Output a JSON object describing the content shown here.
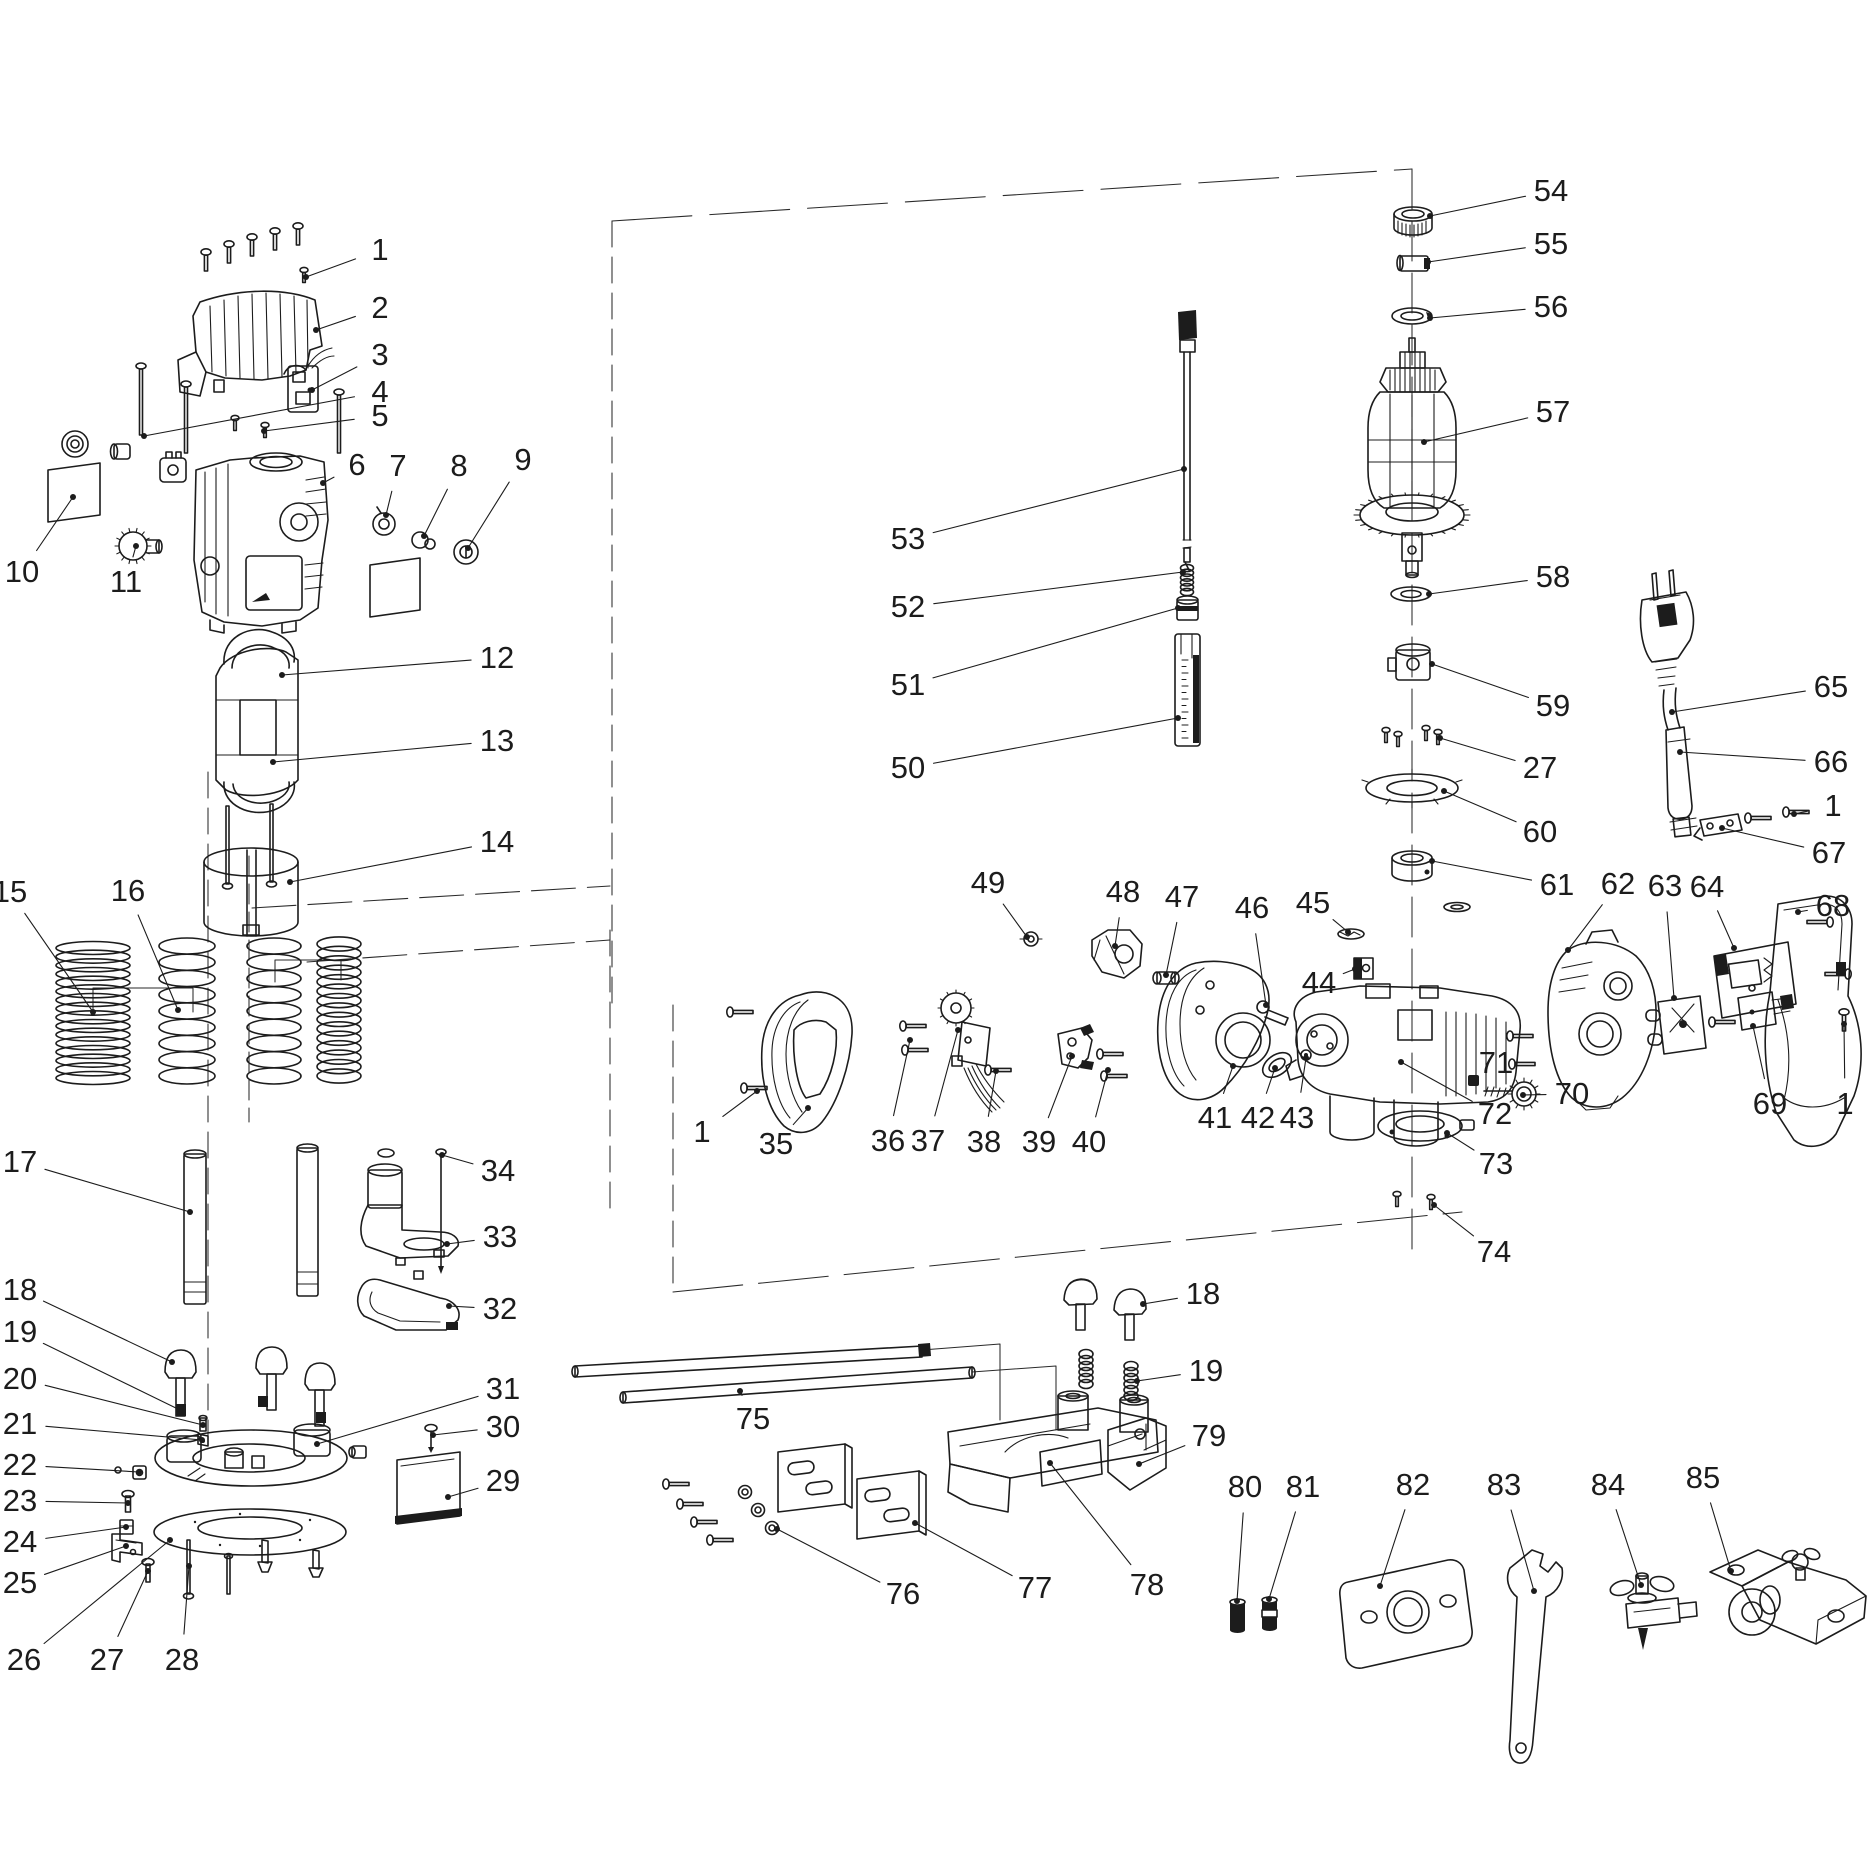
{
  "diagram": {
    "background": "#ffffff",
    "line_color": "#1c1c1c",
    "label_font_px": 31,
    "labels": [
      {
        "t": "1",
        "x": 380,
        "y": 250,
        "lx": 306,
        "ly": 277
      },
      {
        "t": "2",
        "x": 380,
        "y": 308,
        "lx": 316,
        "ly": 330
      },
      {
        "t": "3",
        "x": 380,
        "y": 355,
        "lx": 312,
        "ly": 390
      },
      {
        "t": "4",
        "x": 380,
        "y": 392,
        "lx": 144,
        "ly": 436
      },
      {
        "t": "5",
        "x": 380,
        "y": 416,
        "lx": 264,
        "ly": 431
      },
      {
        "t": "6",
        "x": 357,
        "y": 465,
        "lx": 323,
        "ly": 483
      },
      {
        "t": "7",
        "x": 398,
        "y": 466,
        "lx": 386,
        "ly": 515
      },
      {
        "t": "8",
        "x": 459,
        "y": 466,
        "lx": 424,
        "ly": 536
      },
      {
        "t": "9",
        "x": 523,
        "y": 460,
        "lx": 468,
        "ly": 548
      },
      {
        "t": "10",
        "x": 22,
        "y": 572,
        "lx": 73,
        "ly": 497
      },
      {
        "t": "11",
        "x": 126,
        "y": 582,
        "lx": 136,
        "ly": 546
      },
      {
        "t": "12",
        "x": 497,
        "y": 658,
        "lx": 282,
        "ly": 675
      },
      {
        "t": "13",
        "x": 497,
        "y": 741,
        "lx": 273,
        "ly": 762
      },
      {
        "t": "14",
        "x": 497,
        "y": 842,
        "lx": 290,
        "ly": 882
      },
      {
        "t": "15",
        "x": 10,
        "y": 892,
        "lx": 93,
        "ly": 1012
      },
      {
        "t": "16",
        "x": 128,
        "y": 891,
        "lx": 178,
        "ly": 1010
      },
      {
        "t": "17",
        "x": 20,
        "y": 1162,
        "lx": 190,
        "ly": 1212
      },
      {
        "t": "18",
        "x": 20,
        "y": 1290,
        "lx": 172,
        "ly": 1362
      },
      {
        "t": "19",
        "x": 20,
        "y": 1332,
        "lx": 180,
        "ly": 1410
      },
      {
        "t": "20",
        "x": 20,
        "y": 1379,
        "lx": 203,
        "ly": 1425
      },
      {
        "t": "21",
        "x": 20,
        "y": 1424,
        "lx": 202,
        "ly": 1440
      },
      {
        "t": "22",
        "x": 20,
        "y": 1465,
        "lx": 139,
        "ly": 1472
      },
      {
        "t": "23",
        "x": 20,
        "y": 1501,
        "lx": 128,
        "ly": 1503
      },
      {
        "t": "24",
        "x": 20,
        "y": 1542,
        "lx": 126,
        "ly": 1527
      },
      {
        "t": "25",
        "x": 20,
        "y": 1583,
        "lx": 126,
        "ly": 1546
      },
      {
        "t": "26",
        "x": 24,
        "y": 1660,
        "lx": 170,
        "ly": 1540
      },
      {
        "t": "27",
        "x": 107,
        "y": 1660,
        "lx": 148,
        "ly": 1571
      },
      {
        "t": "28",
        "x": 182,
        "y": 1660,
        "lx": 189,
        "ly": 1566
      },
      {
        "t": "29",
        "x": 503,
        "y": 1481,
        "lx": 448,
        "ly": 1497
      },
      {
        "t": "30",
        "x": 503,
        "y": 1427,
        "lx": 433,
        "ly": 1435
      },
      {
        "t": "31",
        "x": 503,
        "y": 1389,
        "lx": 317,
        "ly": 1444
      },
      {
        "t": "32",
        "x": 500,
        "y": 1309,
        "lx": 449,
        "ly": 1306
      },
      {
        "t": "33",
        "x": 500,
        "y": 1237,
        "lx": 447,
        "ly": 1244
      },
      {
        "t": "34",
        "x": 498,
        "y": 1171,
        "lx": 442,
        "ly": 1155
      },
      {
        "t": "1",
        "x": 702,
        "y": 1132,
        "lx": 757,
        "ly": 1091
      },
      {
        "t": "35",
        "x": 776,
        "y": 1144,
        "lx": 808,
        "ly": 1108
      },
      {
        "t": "36",
        "x": 888,
        "y": 1141,
        "lx": 910,
        "ly": 1040
      },
      {
        "t": "37",
        "x": 928,
        "y": 1141,
        "lx": 958,
        "ly": 1030
      },
      {
        "t": "38",
        "x": 984,
        "y": 1142,
        "lx": 996,
        "ly": 1071
      },
      {
        "t": "39",
        "x": 1039,
        "y": 1142,
        "lx": 1072,
        "ly": 1056
      },
      {
        "t": "40",
        "x": 1089,
        "y": 1142,
        "lx": 1108,
        "ly": 1070
      },
      {
        "t": "41",
        "x": 1215,
        "y": 1118,
        "lx": 1233,
        "ly": 1066
      },
      {
        "t": "42",
        "x": 1258,
        "y": 1118,
        "lx": 1275,
        "ly": 1068
      },
      {
        "t": "43",
        "x": 1297,
        "y": 1118,
        "lx": 1306,
        "ly": 1058
      },
      {
        "t": "44",
        "x": 1319,
        "y": 983,
        "lx": 1355,
        "ly": 969
      },
      {
        "t": "45",
        "x": 1313,
        "y": 903,
        "lx": 1348,
        "ly": 932
      },
      {
        "t": "46",
        "x": 1252,
        "y": 908,
        "lx": 1266,
        "ly": 1005
      },
      {
        "t": "47",
        "x": 1182,
        "y": 897,
        "lx": 1166,
        "ly": 975
      },
      {
        "t": "48",
        "x": 1123,
        "y": 892,
        "lx": 1115,
        "ly": 946
      },
      {
        "t": "49",
        "x": 988,
        "y": 883,
        "lx": 1027,
        "ly": 937
      },
      {
        "t": "50",
        "x": 908,
        "y": 768,
        "lx": 1178,
        "ly": 718
      },
      {
        "t": "51",
        "x": 908,
        "y": 685,
        "lx": 1178,
        "ly": 608
      },
      {
        "t": "52",
        "x": 908,
        "y": 607,
        "lx": 1183,
        "ly": 572
      },
      {
        "t": "53",
        "x": 908,
        "y": 539,
        "lx": 1184,
        "ly": 469
      },
      {
        "t": "54",
        "x": 1551,
        "y": 191,
        "lx": 1430,
        "ly": 216
      },
      {
        "t": "55",
        "x": 1551,
        "y": 244,
        "lx": 1428,
        "ly": 262
      },
      {
        "t": "56",
        "x": 1551,
        "y": 307,
        "lx": 1430,
        "ly": 318
      },
      {
        "t": "57",
        "x": 1553,
        "y": 412,
        "lx": 1424,
        "ly": 442
      },
      {
        "t": "58",
        "x": 1553,
        "y": 577,
        "lx": 1429,
        "ly": 594
      },
      {
        "t": "59",
        "x": 1553,
        "y": 706,
        "lx": 1432,
        "ly": 664
      },
      {
        "t": "27",
        "x": 1540,
        "y": 768,
        "lx": 1440,
        "ly": 738
      },
      {
        "t": "60",
        "x": 1540,
        "y": 832,
        "lx": 1444,
        "ly": 791
      },
      {
        "t": "61",
        "x": 1557,
        "y": 885,
        "lx": 1432,
        "ly": 861
      },
      {
        "t": "62",
        "x": 1618,
        "y": 884,
        "lx": 1568,
        "ly": 950
      },
      {
        "t": "63",
        "x": 1665,
        "y": 886,
        "lx": 1674,
        "ly": 998
      },
      {
        "t": "64",
        "x": 1707,
        "y": 887,
        "lx": 1734,
        "ly": 948
      },
      {
        "t": "65",
        "x": 1831,
        "y": 687,
        "lx": 1672,
        "ly": 712
      },
      {
        "t": "66",
        "x": 1831,
        "y": 762,
        "lx": 1680,
        "ly": 752
      },
      {
        "t": "1",
        "x": 1833,
        "y": 806,
        "lx": 1794,
        "ly": 814
      },
      {
        "t": "67",
        "x": 1829,
        "y": 853,
        "lx": 1722,
        "ly": 828
      },
      {
        "t": "68",
        "x": 1833,
        "y": 906,
        "lx": 1798,
        "ly": 912
      },
      {
        "t": "69",
        "x": 1770,
        "y": 1104,
        "lx": 1753,
        "ly": 1026
      },
      {
        "t": "1",
        "x": 1845,
        "y": 1104,
        "lx": 1844,
        "ly": 1024
      },
      {
        "t": "70",
        "x": 1572,
        "y": 1094,
        "lx": 1523,
        "ly": 1095
      },
      {
        "t": "71",
        "x": 1496,
        "y": 1063,
        "lx": 1474,
        "ly": 1079
      },
      {
        "t": "72",
        "x": 1495,
        "y": 1114,
        "lx": 1401,
        "ly": 1062
      },
      {
        "t": "73",
        "x": 1496,
        "y": 1164,
        "lx": 1447,
        "ly": 1133
      },
      {
        "t": "74",
        "x": 1494,
        "y": 1252,
        "lx": 1434,
        "ly": 1205
      },
      {
        "t": "18",
        "x": 1203,
        "y": 1294,
        "lx": 1143,
        "ly": 1304
      },
      {
        "t": "19",
        "x": 1206,
        "y": 1371,
        "lx": 1137,
        "ly": 1381
      },
      {
        "t": "79",
        "x": 1209,
        "y": 1436,
        "lx": 1139,
        "ly": 1464
      },
      {
        "t": "75",
        "x": 753,
        "y": 1419,
        "lx": 740,
        "ly": 1391
      },
      {
        "t": "76",
        "x": 903,
        "y": 1594,
        "lx": 777,
        "ly": 1529
      },
      {
        "t": "77",
        "x": 1035,
        "y": 1588,
        "lx": 915,
        "ly": 1523
      },
      {
        "t": "78",
        "x": 1147,
        "y": 1585,
        "lx": 1050,
        "ly": 1463
      },
      {
        "t": "80",
        "x": 1245,
        "y": 1487,
        "lx": 1237,
        "ly": 1601
      },
      {
        "t": "81",
        "x": 1303,
        "y": 1487,
        "lx": 1269,
        "ly": 1599
      },
      {
        "t": "82",
        "x": 1413,
        "y": 1485,
        "lx": 1380,
        "ly": 1586
      },
      {
        "t": "83",
        "x": 1504,
        "y": 1485,
        "lx": 1534,
        "ly": 1591
      },
      {
        "t": "84",
        "x": 1608,
        "y": 1485,
        "lx": 1641,
        "ly": 1585
      },
      {
        "t": "85",
        "x": 1703,
        "y": 1478,
        "lx": 1731,
        "ly": 1571
      }
    ],
    "construction_lines": [
      {
        "p": [
          [
            612,
            221
          ],
          [
            612,
            1003
          ]
        ],
        "d": "26 10"
      },
      {
        "p": [
          [
            612,
            221
          ],
          [
            1412,
            169
          ]
        ],
        "d": "80 18"
      },
      {
        "p": [
          [
            1412,
            169
          ],
          [
            1412,
            1255
          ]
        ],
        "d": "40 12"
      },
      {
        "p": [
          [
            610,
            930
          ],
          [
            610,
            1210
          ]
        ],
        "d": "26 10"
      },
      {
        "p": [
          [
            673,
            1005
          ],
          [
            673,
            1292
          ]
        ],
        "d": "26 10"
      },
      {
        "p": [
          [
            673,
            1292
          ],
          [
            1462,
            1212
          ]
        ],
        "d": "70 16"
      },
      {
        "p": [
          [
            208,
            772
          ],
          [
            208,
            1448
          ]
        ],
        "d": "26 10"
      },
      {
        "p": [
          [
            249,
            856
          ],
          [
            249,
            1122
          ]
        ],
        "d": "20 8"
      },
      {
        "p": [
          [
            252,
            908
          ],
          [
            610,
            886
          ]
        ],
        "d": "44 12"
      },
      {
        "p": [
          [
            307,
            962
          ],
          [
            610,
            940
          ]
        ],
        "d": "44 12"
      },
      {
        "p": [
          [
            93,
            1012
          ],
          [
            93,
            988
          ],
          [
            193,
            988
          ],
          [
            193,
            1012
          ]
        ],
        "d": ""
      },
      {
        "p": [
          [
            275,
            982
          ],
          [
            275,
            960
          ],
          [
            341,
            960
          ],
          [
            341,
            980
          ]
        ],
        "d": ""
      },
      {
        "p": [
          [
            922,
            1350
          ],
          [
            1000,
            1344
          ],
          [
            1000,
            1420
          ]
        ],
        "d": ""
      },
      {
        "p": [
          [
            972,
            1372
          ],
          [
            1056,
            1366
          ],
          [
            1056,
            1430
          ]
        ],
        "d": ""
      }
    ]
  }
}
